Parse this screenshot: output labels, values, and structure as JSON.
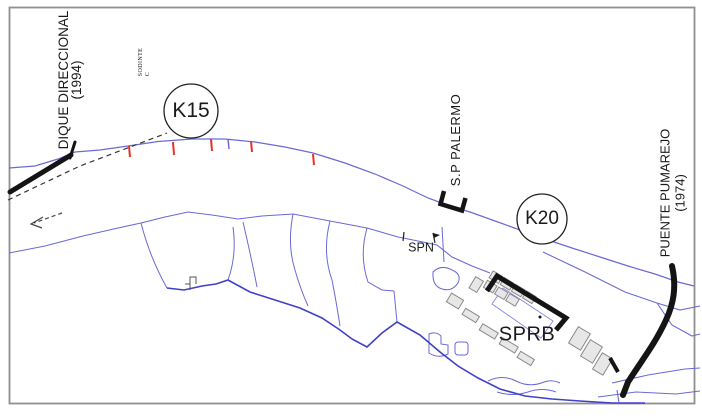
{
  "map": {
    "labels": {
      "dique": {
        "name": "DIQUE DIRECCIONAL",
        "year": "(1994)"
      },
      "sodinte": {
        "line1": "SODINTE",
        "line2": "C"
      },
      "k15": "K15",
      "k20": "K20",
      "palermo": "S.P PALERMO",
      "spn": "SPN",
      "sprb": "SPRB",
      "pumarejo": {
        "name": "PUENTE PUMAREJO",
        "year": "(1974)"
      }
    },
    "icons": {
      "flow_arrow": "dashed-arrow-pointing-left",
      "k15_marker": "circled-kilometer-post",
      "k20_marker": "circled-kilometer-post",
      "palermo_dock": "black-quay-bracket",
      "sprb_dock": "black-quay-line",
      "bridge": "thick-curved-bridge-line",
      "bank_ticks": "red-erosion-control-ticks"
    },
    "colors": {
      "background": "#ffffff",
      "ink": "#1a1a1a",
      "frame": "#909090",
      "river_line": "#6a6ad6",
      "channel_dark": "#4040c8",
      "marker_red": "#e5322a",
      "structure_black": "#141414",
      "building_fill": "#e7e7e7",
      "building_stroke": "#8a8a8a"
    }
  }
}
